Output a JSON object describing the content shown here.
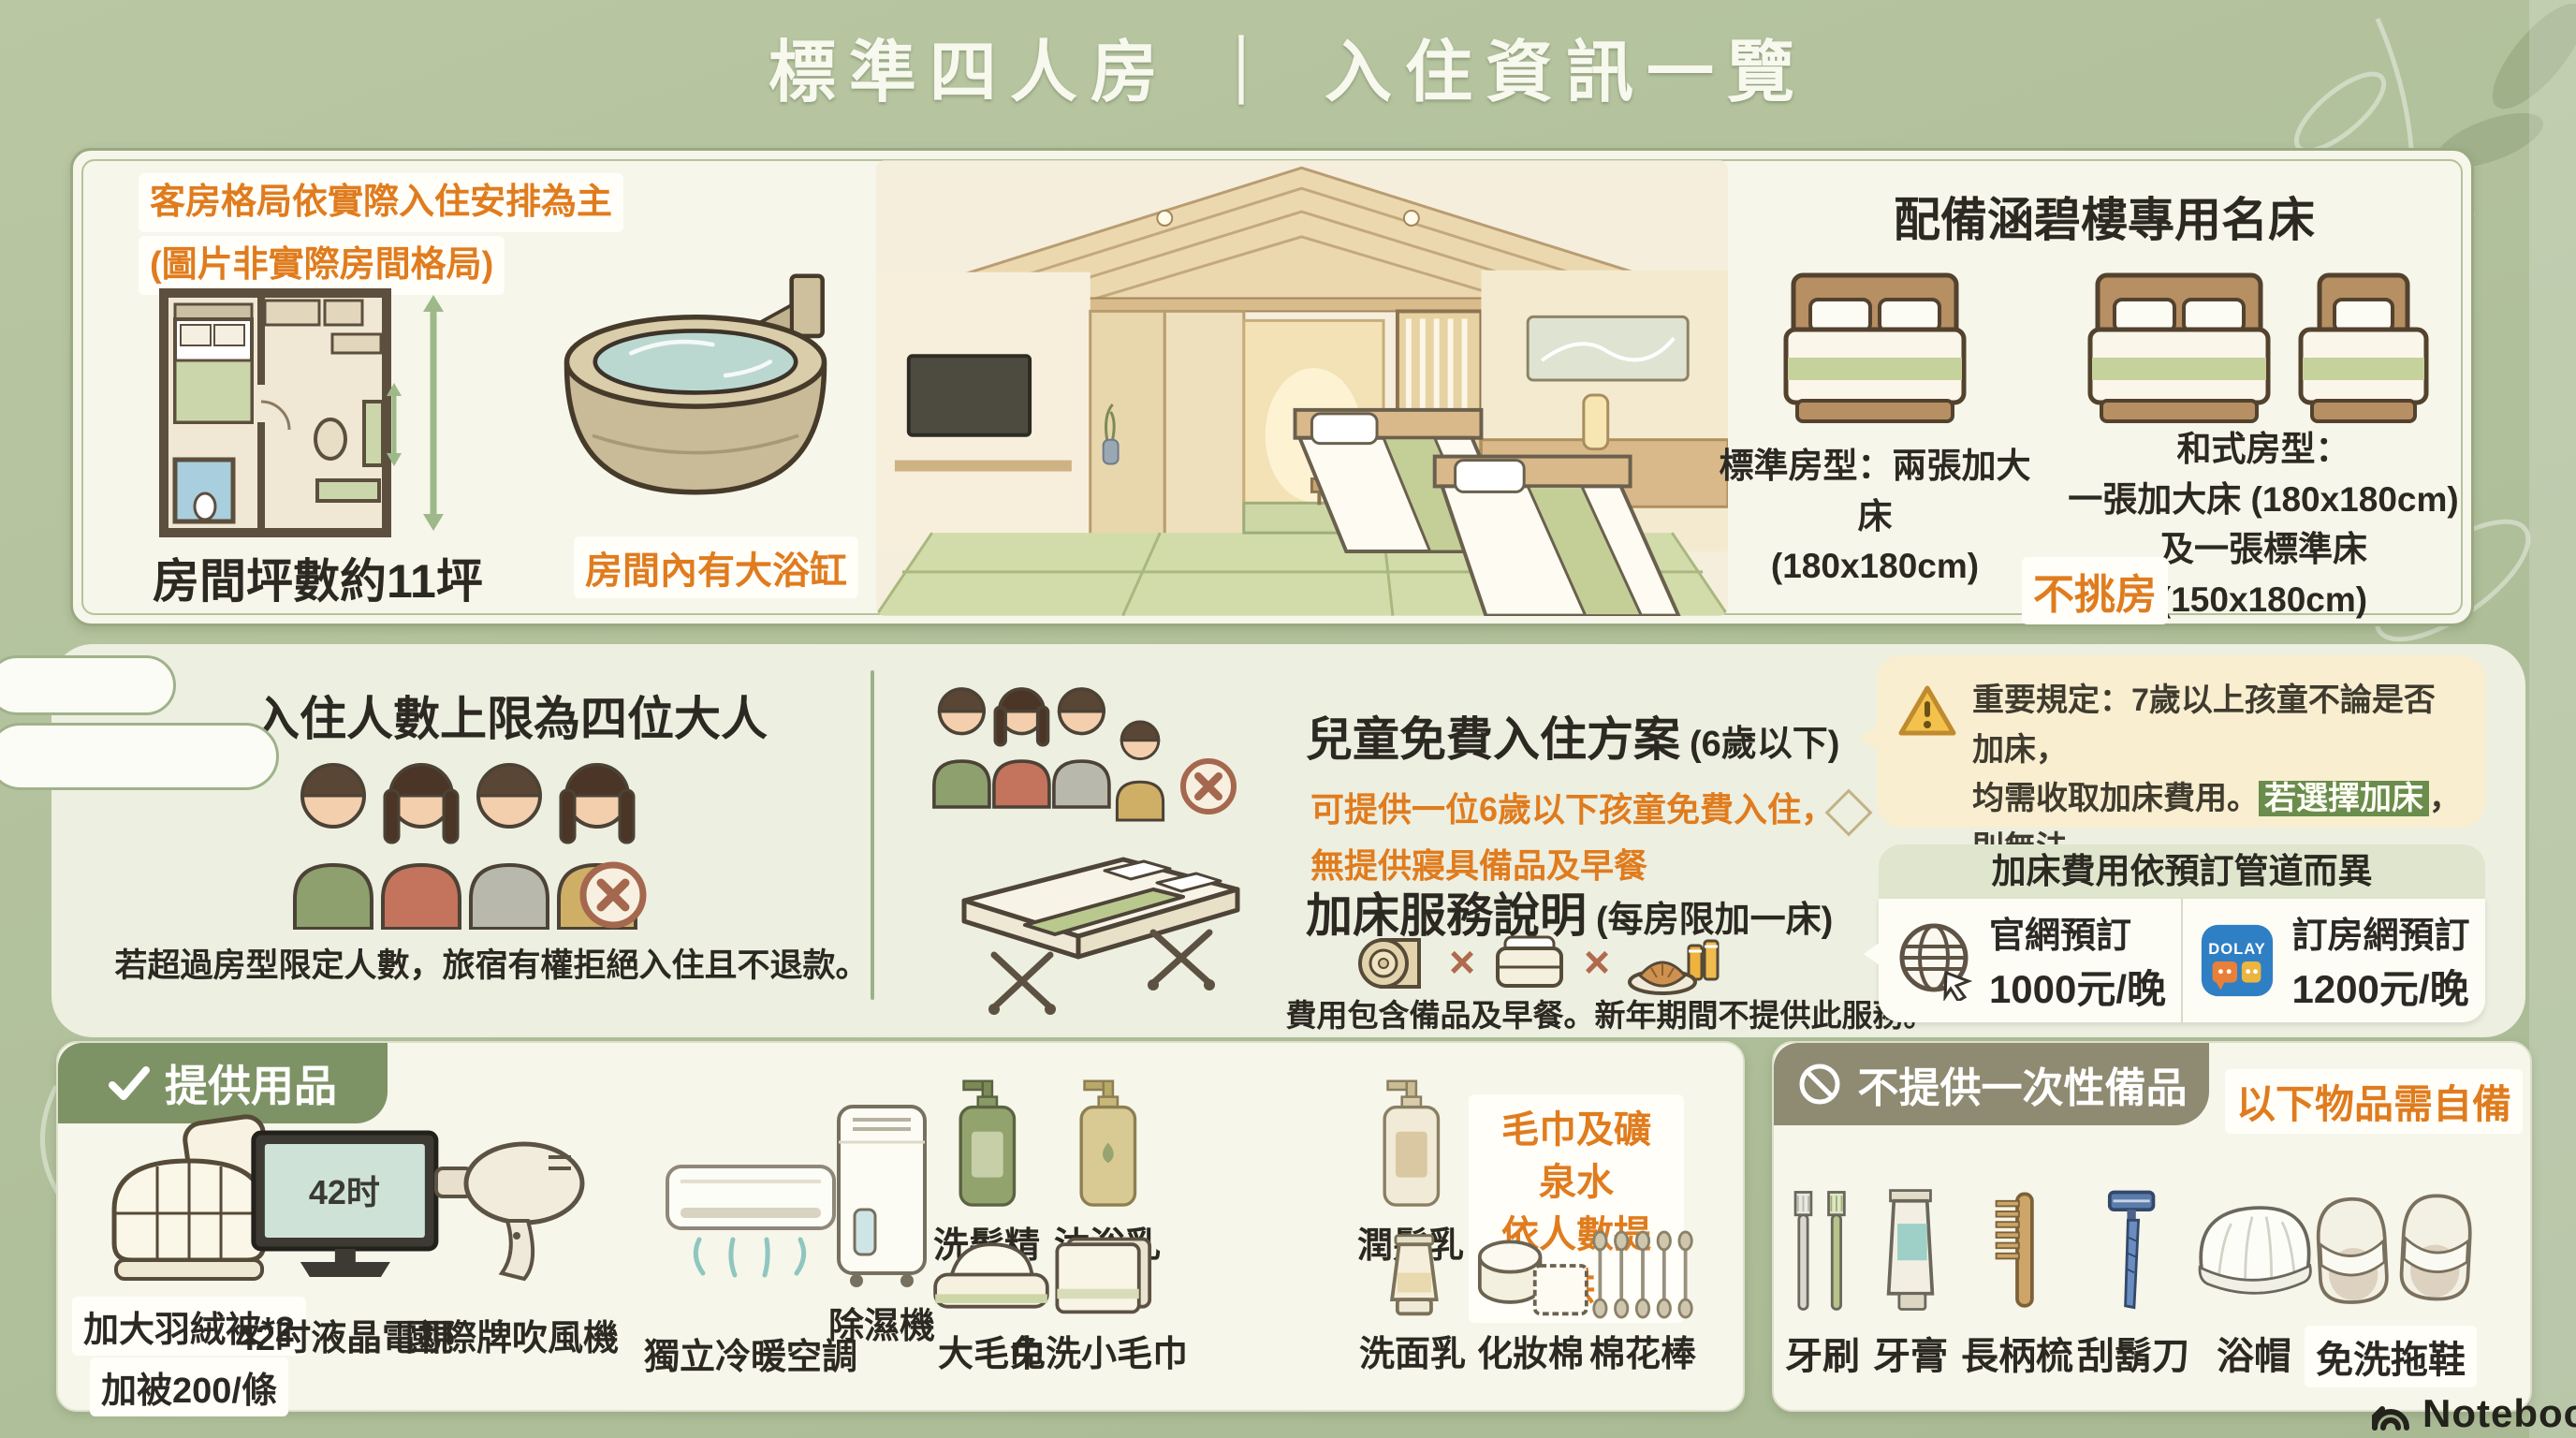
{
  "page": {
    "title": "標準四人房 ｜ 入住資訊一覽",
    "brand": "NotebookLM"
  },
  "colors": {
    "background": "#b0c09a",
    "card": "#f6f6ea",
    "accent_orange": "#e07c1e",
    "badge_green": "#7e9365",
    "badge_olive": "#8f8b72",
    "warning_bg": "#f9eecf",
    "highlight_green": "#6a8c4c"
  },
  "top_card": {
    "note1": "客房格局依實際入住安排為主",
    "note2": "(圖片非實際房間格局)",
    "size_label": "房間坪數約11坪",
    "bathtub_label": "房間內有大浴缸",
    "beds": {
      "title": "配備涵碧樓專用名床",
      "standard1": "標準房型：兩張加大床",
      "standard2": "(180x180cm)",
      "jp1": "和式房型：",
      "jp2": "一張加大床 (180x180cm)",
      "jp3": "及一張標準床 (150x180cm)",
      "no_choice": "不挑房"
    }
  },
  "occupancy": {
    "title": "入住人數上限為四位大人",
    "note": "若超過房型限定人數，旅宿有權拒絕入住且不退款。"
  },
  "child_policy": {
    "title": "兒童免費入住方案",
    "suffix": "(6歲以下)",
    "line1": "可提供一位6歲以下孩童免費入住，",
    "line2": "無提供寢具備品及早餐"
  },
  "extra_bed": {
    "title": "加床服務說明",
    "suffix": "(每房限加一床)",
    "note": "費用包含備品及早餐。新年期間不提供此服務。"
  },
  "warning": {
    "line1": "重要規定：7歲以上孩童不論是否加床，",
    "line2_pre": "均需收取加床費用。",
    "line2_highlight": "若選擇加床",
    "line2_post": "，則無法",
    "line3": "同時使用6歲以下孩童免費入住方案。"
  },
  "fees": {
    "title": "加床費用依預訂管道而異",
    "official": {
      "label": "官網預訂",
      "price": "1000元/晚"
    },
    "ota": {
      "label": "訂房網預訂",
      "price": "1200元/晚",
      "app": "DOLAY"
    }
  },
  "provided": {
    "header": "提供用品",
    "note1": "毛巾及礦泉水",
    "note2": "依人數提供",
    "items": [
      {
        "icon": "duvet-icon",
        "label": "加大羽絨被*2",
        "label2": "加被200/條"
      },
      {
        "icon": "tv-icon",
        "label": "42时液晶電視",
        "screen": "42时"
      },
      {
        "icon": "hairdryer-icon",
        "label": "國際牌吹風機"
      },
      {
        "icon": "aircon-icon",
        "label": "獨立冷暖空調"
      },
      {
        "icon": "dehumidifier-icon",
        "label": "除濕機"
      },
      {
        "icon": "shampoo-icon",
        "label": "洗髮精"
      },
      {
        "icon": "bodywash-icon",
        "label": "沐浴乳"
      },
      {
        "icon": "conditioner-icon",
        "label": "潤髮乳"
      },
      {
        "icon": "large-towel-icon",
        "label": "大毛巾"
      },
      {
        "icon": "small-towel-icon",
        "label": "免洗小毛巾"
      },
      {
        "icon": "facewash-icon",
        "label": "洗面乳"
      },
      {
        "icon": "cotton-pad-icon",
        "label": "化妝棉"
      },
      {
        "icon": "cotton-swab-icon",
        "label": "棉花棒"
      }
    ]
  },
  "not_provided": {
    "header": "不提供一次性備品",
    "note": "以下物品需自備",
    "items": [
      {
        "icon": "toothbrush-icon",
        "label": "牙刷"
      },
      {
        "icon": "toothpaste-icon",
        "label": "牙膏"
      },
      {
        "icon": "comb-icon",
        "label": "長柄梳"
      },
      {
        "icon": "razor-icon",
        "label": "刮鬍刀"
      },
      {
        "icon": "shower-cap-icon",
        "label": "浴帽"
      },
      {
        "icon": "slippers-icon",
        "label": "免洗拖鞋"
      }
    ]
  }
}
